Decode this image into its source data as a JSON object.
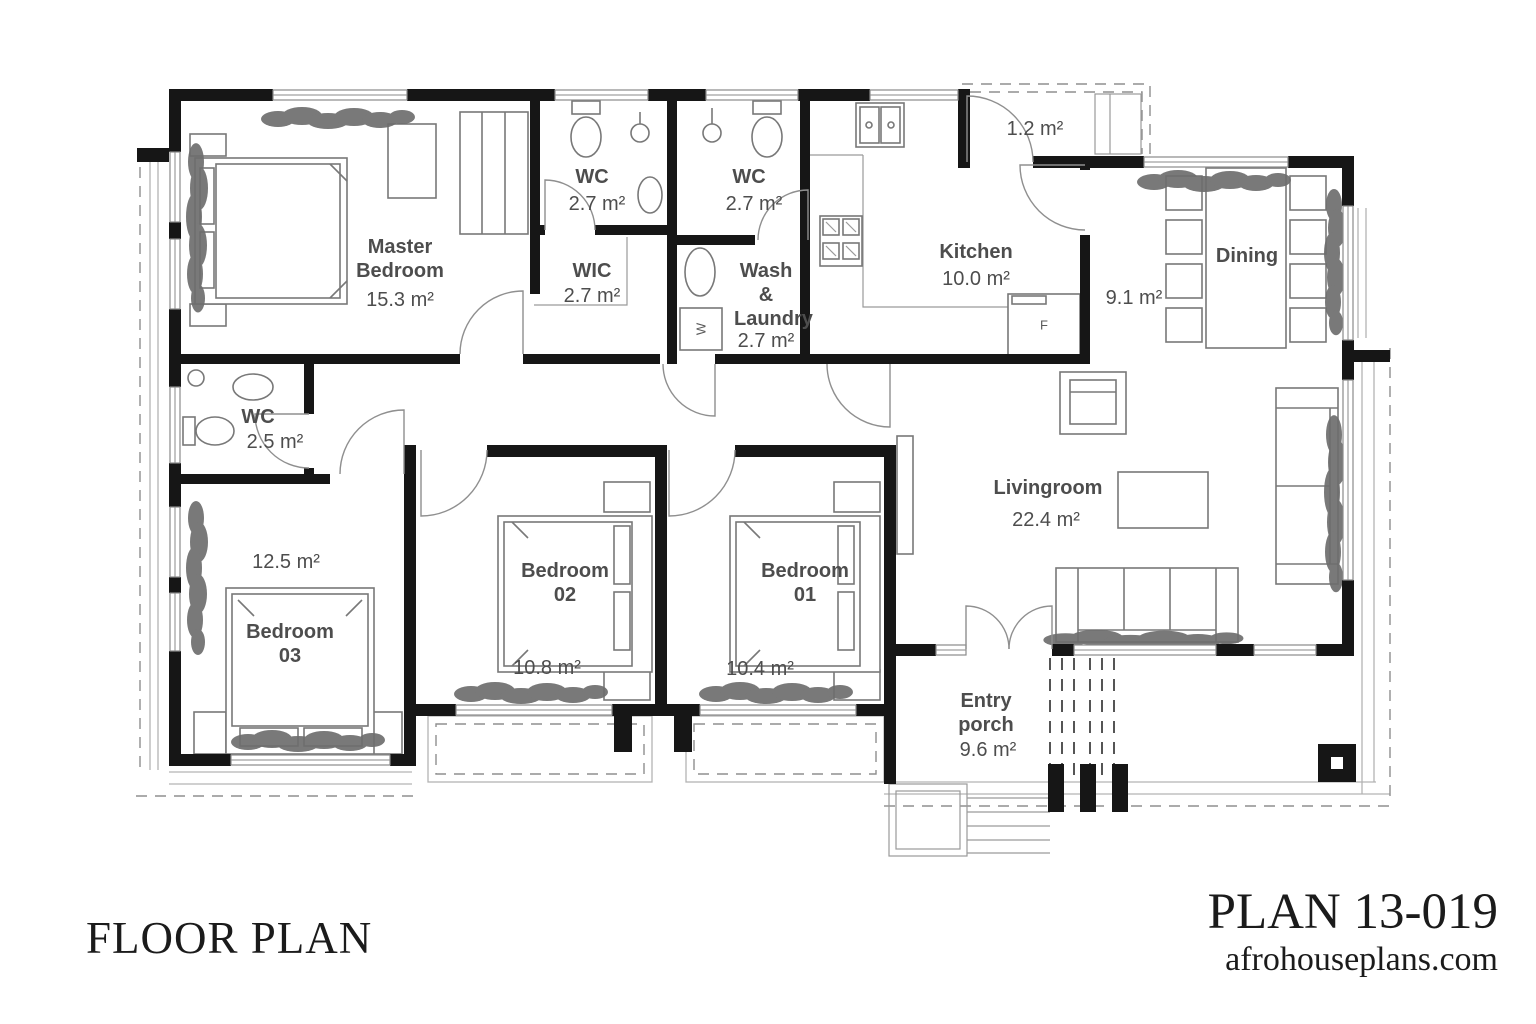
{
  "footer": {
    "title": "FLOOR PLAN",
    "plan_number": "PLAN 13-019",
    "website": "afrohouseplans.com"
  },
  "rooms": {
    "master_bedroom": {
      "name": "Master Bedroom",
      "area": "15.3 m²"
    },
    "wc_master": {
      "name": "WC",
      "area": "2.7 m²"
    },
    "wc_top": {
      "name": "WC",
      "area": "2.7 m²"
    },
    "wic": {
      "name": "WIC",
      "area": "2.7 m²"
    },
    "wash_laundry": {
      "name": "Wash & Laundry",
      "area": "2.7 m²"
    },
    "kitchen": {
      "name": "Kitchen",
      "area": "10.0 m²"
    },
    "side_stoop": {
      "area": "1.2 m²"
    },
    "dining": {
      "name": "Dining",
      "area": "9.1 m²"
    },
    "wc_hall": {
      "name": "WC",
      "area": "2.5 m²"
    },
    "bedroom_03": {
      "name": "Bedroom 03",
      "area": "12.5 m²"
    },
    "bedroom_02": {
      "name": "Bedroom 02",
      "area": "10.8 m²"
    },
    "bedroom_01": {
      "name": "Bedroom 01",
      "area": "10.4 m²"
    },
    "livingroom": {
      "name": "Livingroom",
      "area": "22.4 m²"
    },
    "entry_porch": {
      "name": "Entry porch",
      "area": "9.6 m²"
    }
  },
  "appliances": {
    "washer": "W",
    "fridge": "F"
  },
  "colors": {
    "wall": "#161616",
    "label": "#4d4d4d",
    "furniture": "#787878",
    "plant": "#6e6e6e"
  }
}
